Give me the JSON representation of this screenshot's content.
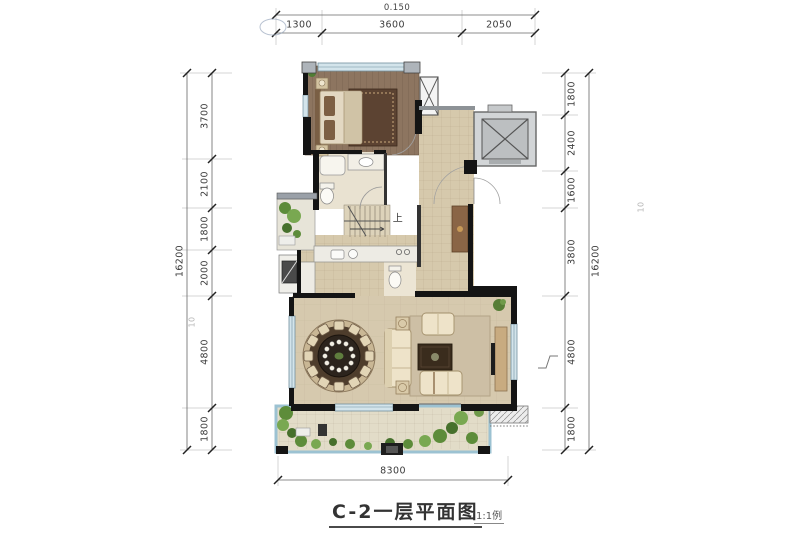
{
  "document": {
    "title": "C-2一层平面图",
    "scale_note": "1:1例"
  },
  "dimensions": {
    "top_total": "0.150",
    "top_chain": [
      "1300",
      "3600",
      "2050"
    ],
    "left_total": "16200",
    "left_chain": [
      "3700",
      "2100",
      "1800",
      "2000",
      "4800",
      "1800"
    ],
    "right_chain": [
      "1800",
      "2400",
      "1600",
      "3800",
      "4800",
      "1800"
    ],
    "right_total": "16200",
    "bottom_total": "8300",
    "grid_label_left": "10",
    "grid_label_right": "10"
  },
  "plan": {
    "stairs_label": "上"
  },
  "colors": {
    "wall": "#141414",
    "wood_floor": "#8d7560",
    "tile_floor": "#d6c9ac",
    "living_floor": "#d6c9ae",
    "elevator": "#bcbfc1",
    "window": "#d3e4eb",
    "terrace_edge": "#9cc2d2",
    "vegetation": "#5d8c3a",
    "dim_text": "#3b3b3b"
  }
}
